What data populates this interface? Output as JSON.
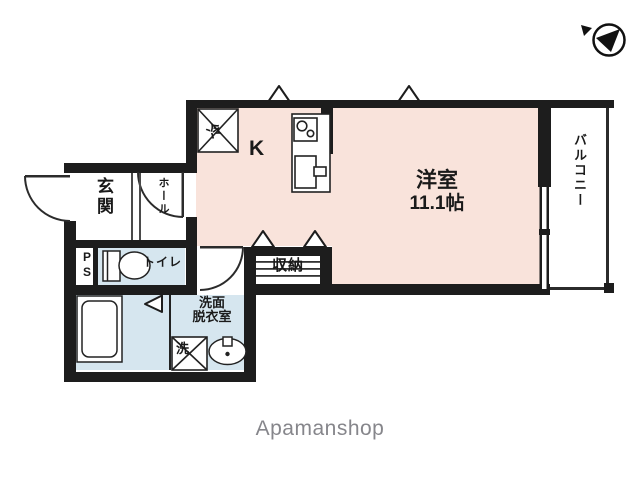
{
  "watermark": "Apamanshop",
  "colors": {
    "wall": "#1d1d1d",
    "room_pink": "#f9e3db",
    "room_blue": "#d6e6ef",
    "line": "#2b2b2b",
    "watermark_gray": "#86868b"
  },
  "icons": {
    "compass": "north-compass-icon",
    "vents": "vent-hood-icon",
    "doors": "door-swing-arc",
    "fixtures": [
      "toilet-icon",
      "bathtub-icon",
      "sink-icon",
      "stove-icon",
      "kitchen-sink-icon",
      "washer-box-icon",
      "fridge-box-icon"
    ]
  },
  "rooms": {
    "genkan": {
      "label": "玄関"
    },
    "hall": {
      "label": "ホール"
    },
    "ps": {
      "label": "PS"
    },
    "toilet": {
      "label": "トイレ"
    },
    "washroom": {
      "label_line1": "洗面",
      "label_line2": "脱衣室"
    },
    "washer": {
      "label": "洗"
    },
    "fridge": {
      "label": "冷"
    },
    "kitchen": {
      "label": "K"
    },
    "closet": {
      "label": "収納"
    },
    "living": {
      "label": "洋室",
      "size": "11.1帖"
    },
    "balcony": {
      "label": "バルコニー"
    }
  }
}
